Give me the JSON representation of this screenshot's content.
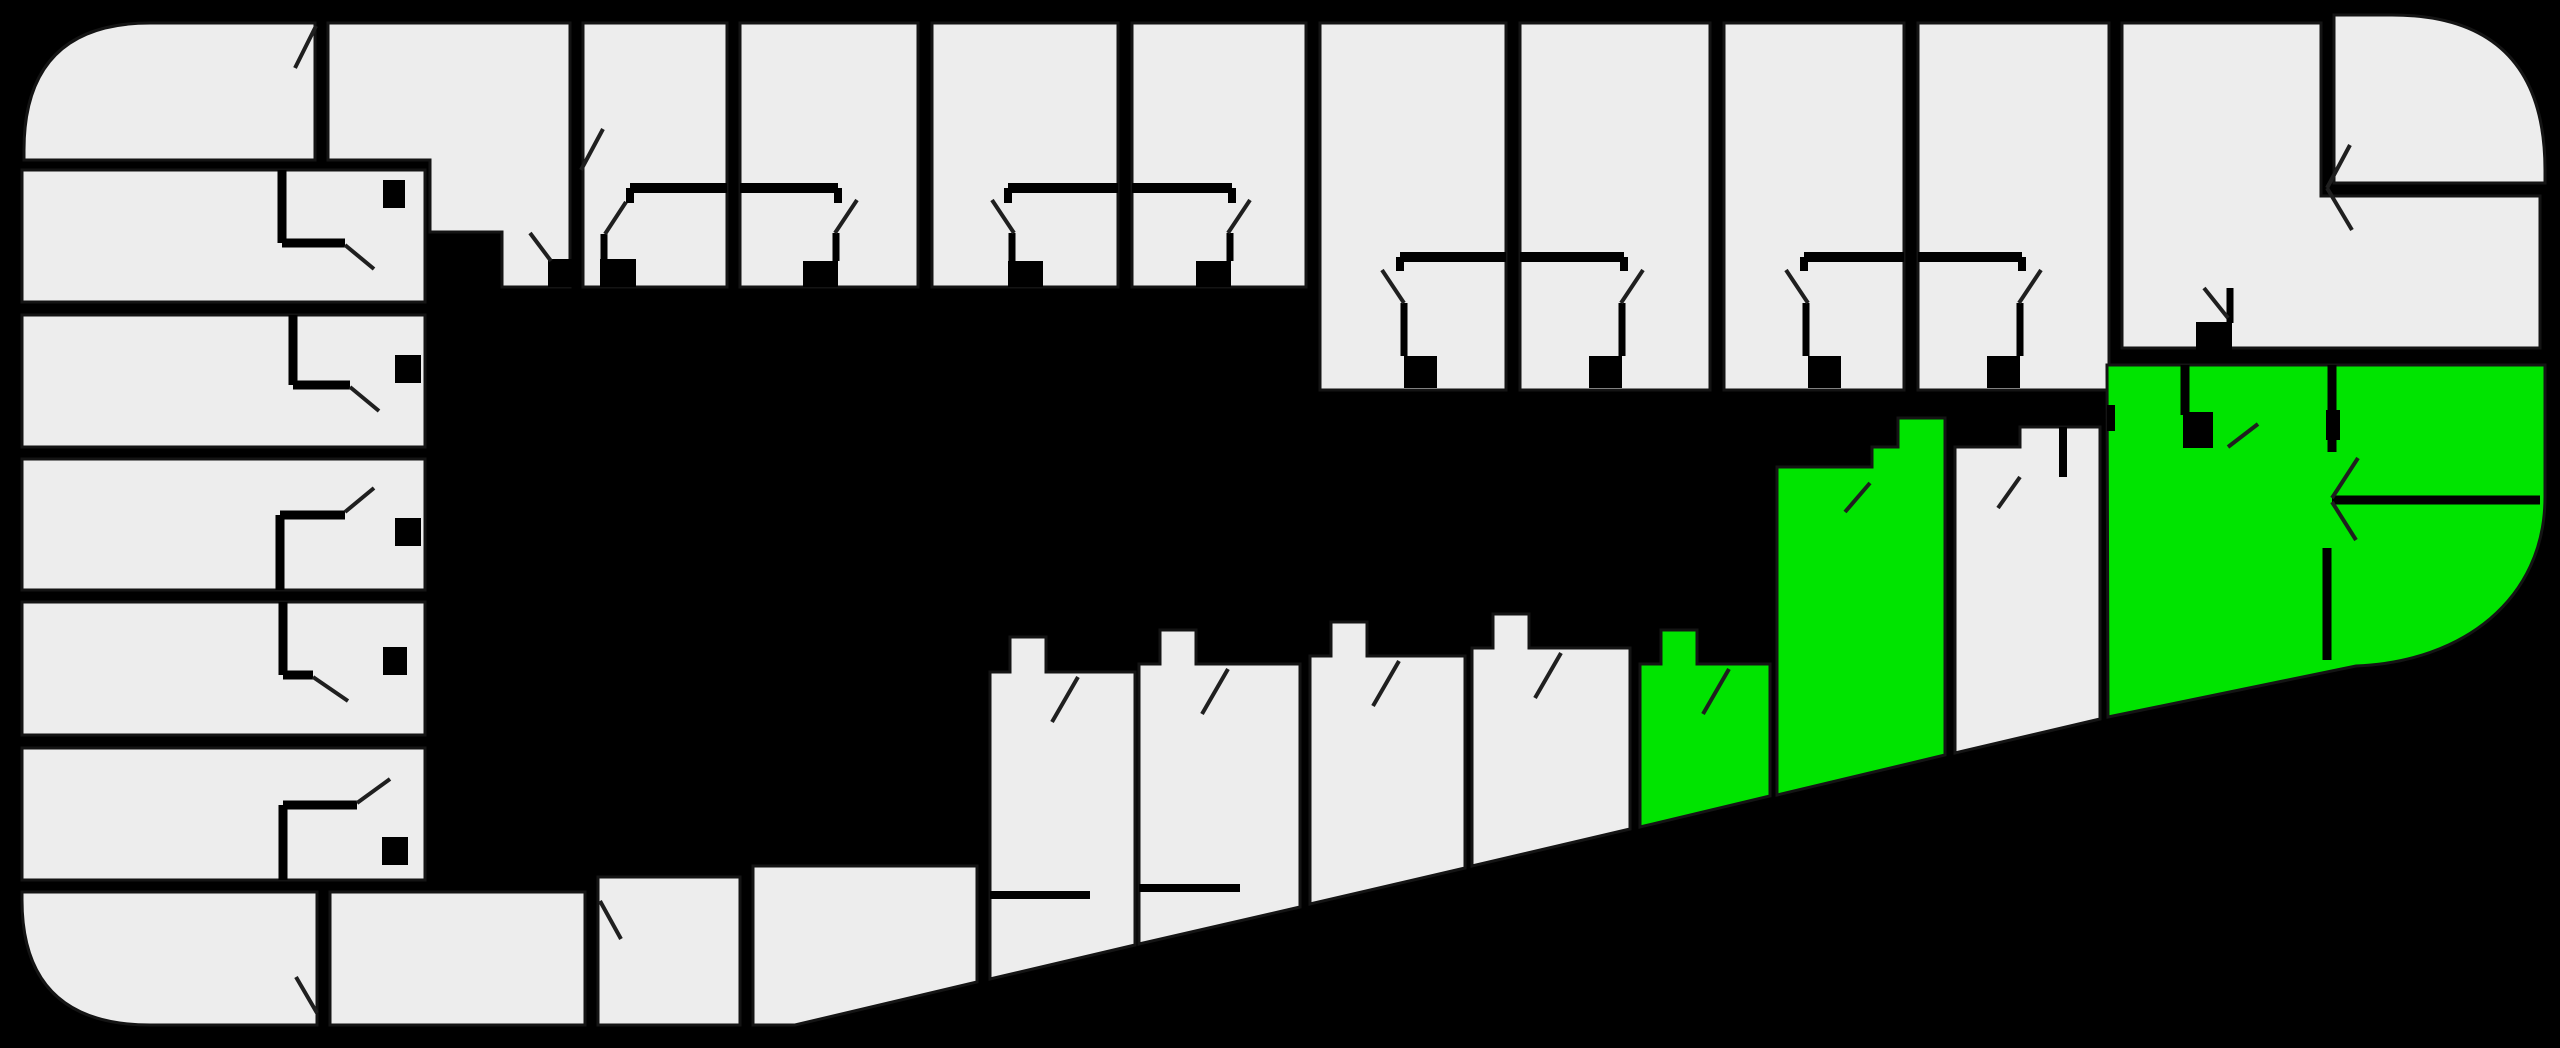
{
  "plan": {
    "title": "building-floor-plan",
    "canvas": {
      "width": 2560,
      "height": 1048,
      "background": "#000000"
    },
    "palette": {
      "unit_fill": "#ededed",
      "available_fill": "#00e400",
      "wall": "#000000",
      "door_line": "#1f1f1f",
      "unit_outline": "#141414"
    },
    "counts": {
      "total_units": 21,
      "available_units": 3
    },
    "units": [
      {
        "id": "L1",
        "status": "occupied",
        "d": "M150,23 H315 V160 H24 V150 Q24,23 150,23 Z"
      },
      {
        "id": "L2",
        "status": "occupied",
        "d": "M22,170 H425 V302 H22 Z"
      },
      {
        "id": "L3",
        "status": "occupied",
        "d": "M22,315 H425 V447 H22 Z"
      },
      {
        "id": "L4",
        "status": "occupied",
        "d": "M22,459 H425 V590 H22 Z"
      },
      {
        "id": "L5",
        "status": "occupied",
        "d": "M22,602 H425 V735 H22 Z"
      },
      {
        "id": "L6",
        "status": "occupied",
        "d": "M22,748 H425 V880 H22 Z"
      },
      {
        "id": "L7",
        "status": "occupied",
        "d": "M22,892 H317 V1025 H150 Q22,1025 22,900 Z"
      },
      {
        "id": "B1",
        "status": "occupied",
        "d": "M330,892 H585 V1025 H330 Z"
      },
      {
        "id": "B2",
        "status": "occupied",
        "d": "M598,877 H740 V1025 H598 Z"
      },
      {
        "id": "B3",
        "status": "occupied",
        "d": "M753,866 H977 V982 L795,1025 H753 Z"
      },
      {
        "id": "T1",
        "status": "occupied",
        "d": "M328,23 H570 V287 H502 V232 H430 V160 H328 Z"
      },
      {
        "id": "T2",
        "status": "occupied",
        "d": "M583,23 H727 V287 H583 Z"
      },
      {
        "id": "T3",
        "status": "occupied",
        "d": "M740,23 H918 V287 H740 Z"
      },
      {
        "id": "T4",
        "status": "occupied",
        "d": "M932,23 H1118 V287 H932 Z"
      },
      {
        "id": "T5",
        "status": "occupied",
        "d": "M1132,23 H1306 V287 H1132 Z"
      },
      {
        "id": "T6",
        "status": "occupied",
        "d": "M1320,23 H1506 V390 H1320 Z"
      },
      {
        "id": "T7",
        "status": "occupied",
        "d": "M1520,23 H1710 V390 H1520 Z"
      },
      {
        "id": "T8",
        "status": "occupied",
        "d": "M1724,23 H1904 V390 H1724 Z"
      },
      {
        "id": "T9",
        "status": "occupied",
        "d": "M1918,23 H2109 V390 H1918 Z"
      },
      {
        "id": "T10",
        "status": "occupied",
        "d": "M2122,23 H2321 V196 H2540 V348 H2122 Z"
      },
      {
        "id": "T11",
        "status": "occupied",
        "d": "M2334,15 H2392 Q2545,15 2545,170 V183 H2334 Z"
      },
      {
        "id": "C1",
        "status": "occupied",
        "d": "M990,672 H1010 V637 H1046 V672 H1135 V945 L990,979 Z"
      },
      {
        "id": "C2",
        "status": "occupied",
        "d": "M1139,664 H1160 V630 H1196 V664 H1300 V907 L1139,944 Z"
      },
      {
        "id": "C3",
        "status": "occupied",
        "d": "M1310,656 H1331 V622 H1367 V656 H1465 V868 L1310,904 Z"
      },
      {
        "id": "C4",
        "status": "occupied",
        "d": "M1472,648 H1493 V614 H1529 V648 H1630 V829 L1472,866 Z"
      },
      {
        "id": "M1",
        "status": "available",
        "d": "M1640,664 H1661 V630 H1697 V664 H1770 V796 L1640,827 Z"
      },
      {
        "id": "M2",
        "status": "available",
        "d": "M1777,467 H1872 V447 H1898 V418 H1945 V755 L1777,795 Z"
      },
      {
        "id": "D1",
        "status": "occupied",
        "d": "M1955,447 H2020 V427 H2100 V719 L1955,753 Z"
      },
      {
        "id": "G1",
        "status": "available",
        "d": "M2107,365 H2545 V497 C2545,600 2462,662 2356,666 L2108,717 Z"
      }
    ],
    "interior_walls": [
      {
        "x1": 282,
        "y1": 170,
        "x2": 282,
        "y2": 243,
        "w": 9
      },
      {
        "x1": 282,
        "y1": 243,
        "x2": 345,
        "y2": 243,
        "w": 9
      },
      {
        "x1": 293,
        "y1": 315,
        "x2": 293,
        "y2": 385,
        "w": 9
      },
      {
        "x1": 293,
        "y1": 385,
        "x2": 350,
        "y2": 385,
        "w": 9
      },
      {
        "x1": 280,
        "y1": 515,
        "x2": 345,
        "y2": 515,
        "w": 9
      },
      {
        "x1": 280,
        "y1": 515,
        "x2": 280,
        "y2": 590,
        "w": 9
      },
      {
        "x1": 283,
        "y1": 602,
        "x2": 283,
        "y2": 675,
        "w": 9
      },
      {
        "x1": 283,
        "y1": 675,
        "x2": 313,
        "y2": 675,
        "w": 9
      },
      {
        "x1": 283,
        "y1": 805,
        "x2": 357,
        "y2": 805,
        "w": 9
      },
      {
        "x1": 283,
        "y1": 805,
        "x2": 283,
        "y2": 880,
        "w": 9
      },
      {
        "x1": 630,
        "y1": 188,
        "x2": 727,
        "y2": 188,
        "w": 10
      },
      {
        "x1": 630,
        "y1": 188,
        "x2": 630,
        "y2": 203,
        "w": 8
      },
      {
        "x1": 740,
        "y1": 188,
        "x2": 838,
        "y2": 188,
        "w": 10
      },
      {
        "x1": 838,
        "y1": 188,
        "x2": 838,
        "y2": 203,
        "w": 8
      },
      {
        "x1": 1008,
        "y1": 188,
        "x2": 1118,
        "y2": 188,
        "w": 10
      },
      {
        "x1": 1008,
        "y1": 188,
        "x2": 1008,
        "y2": 203,
        "w": 8
      },
      {
        "x1": 1132,
        "y1": 188,
        "x2": 1232,
        "y2": 188,
        "w": 10
      },
      {
        "x1": 1232,
        "y1": 188,
        "x2": 1232,
        "y2": 203,
        "w": 8
      },
      {
        "x1": 1400,
        "y1": 257,
        "x2": 1506,
        "y2": 257,
        "w": 10
      },
      {
        "x1": 1400,
        "y1": 257,
        "x2": 1400,
        "y2": 271,
        "w": 8
      },
      {
        "x1": 1520,
        "y1": 257,
        "x2": 1624,
        "y2": 257,
        "w": 10
      },
      {
        "x1": 1624,
        "y1": 257,
        "x2": 1624,
        "y2": 271,
        "w": 8
      },
      {
        "x1": 1804,
        "y1": 257,
        "x2": 1904,
        "y2": 257,
        "w": 10
      },
      {
        "x1": 1804,
        "y1": 257,
        "x2": 1804,
        "y2": 271,
        "w": 8
      },
      {
        "x1": 1918,
        "y1": 257,
        "x2": 2022,
        "y2": 257,
        "w": 10
      },
      {
        "x1": 2022,
        "y1": 257,
        "x2": 2022,
        "y2": 271,
        "w": 8
      },
      {
        "x1": 604,
        "y1": 234,
        "x2": 604,
        "y2": 261,
        "w": 7
      },
      {
        "x1": 836,
        "y1": 233,
        "x2": 836,
        "y2": 261,
        "w": 7
      },
      {
        "x1": 1012,
        "y1": 233,
        "x2": 1012,
        "y2": 261,
        "w": 7
      },
      {
        "x1": 1230,
        "y1": 233,
        "x2": 1230,
        "y2": 261,
        "w": 7
      },
      {
        "x1": 1404,
        "y1": 303,
        "x2": 1404,
        "y2": 356,
        "w": 7
      },
      {
        "x1": 1622,
        "y1": 303,
        "x2": 1622,
        "y2": 356,
        "w": 7
      },
      {
        "x1": 1806,
        "y1": 303,
        "x2": 1806,
        "y2": 356,
        "w": 7
      },
      {
        "x1": 2020,
        "y1": 303,
        "x2": 2020,
        "y2": 356,
        "w": 7
      },
      {
        "x1": 2230,
        "y1": 288,
        "x2": 2230,
        "y2": 323,
        "w": 7
      },
      {
        "x1": 990,
        "y1": 895,
        "x2": 1090,
        "y2": 895,
        "w": 8
      },
      {
        "x1": 1139,
        "y1": 888,
        "x2": 1240,
        "y2": 888,
        "w": 8
      },
      {
        "x1": 2063,
        "y1": 427,
        "x2": 2063,
        "y2": 477,
        "w": 8
      },
      {
        "x1": 2332,
        "y1": 365,
        "x2": 2332,
        "y2": 452,
        "w": 9
      },
      {
        "x1": 2332,
        "y1": 500,
        "x2": 2540,
        "y2": 500,
        "w": 9
      },
      {
        "x1": 2327,
        "y1": 548,
        "x2": 2327,
        "y2": 660,
        "w": 9
      },
      {
        "x1": 2185,
        "y1": 365,
        "x2": 2185,
        "y2": 415,
        "w": 9
      }
    ],
    "door_swings": [
      {
        "x1": 295,
        "y1": 68,
        "x2": 316,
        "y2": 26
      },
      {
        "x1": 345,
        "y1": 245,
        "x2": 374,
        "y2": 269
      },
      {
        "x1": 350,
        "y1": 387,
        "x2": 379,
        "y2": 411
      },
      {
        "x1": 345,
        "y1": 512,
        "x2": 374,
        "y2": 488
      },
      {
        "x1": 313,
        "y1": 677,
        "x2": 348,
        "y2": 701
      },
      {
        "x1": 357,
        "y1": 803,
        "x2": 390,
        "y2": 779
      },
      {
        "x1": 296,
        "y1": 977,
        "x2": 317,
        "y2": 1013
      },
      {
        "x1": 600,
        "y1": 901,
        "x2": 621,
        "y2": 939
      },
      {
        "x1": 530,
        "y1": 233,
        "x2": 551,
        "y2": 261
      },
      {
        "x1": 581,
        "y1": 170,
        "x2": 603,
        "y2": 129
      },
      {
        "x1": 626,
        "y1": 202,
        "x2": 605,
        "y2": 234
      },
      {
        "x1": 857,
        "y1": 200,
        "x2": 835,
        "y2": 233
      },
      {
        "x1": 992,
        "y1": 200,
        "x2": 1014,
        "y2": 233
      },
      {
        "x1": 1250,
        "y1": 200,
        "x2": 1228,
        "y2": 233
      },
      {
        "x1": 1382,
        "y1": 270,
        "x2": 1404,
        "y2": 303
      },
      {
        "x1": 1643,
        "y1": 270,
        "x2": 1621,
        "y2": 303
      },
      {
        "x1": 1786,
        "y1": 270,
        "x2": 1808,
        "y2": 303
      },
      {
        "x1": 2041,
        "y1": 270,
        "x2": 2019,
        "y2": 303
      },
      {
        "x1": 2204,
        "y1": 288,
        "x2": 2228,
        "y2": 318
      },
      {
        "x1": 2327,
        "y1": 188,
        "x2": 2350,
        "y2": 145
      },
      {
        "x1": 2327,
        "y1": 188,
        "x2": 2352,
        "y2": 230
      },
      {
        "x1": 1078,
        "y1": 677,
        "x2": 1052,
        "y2": 722
      },
      {
        "x1": 1228,
        "y1": 669,
        "x2": 1202,
        "y2": 714
      },
      {
        "x1": 1399,
        "y1": 661,
        "x2": 1373,
        "y2": 706
      },
      {
        "x1": 1561,
        "y1": 653,
        "x2": 1535,
        "y2": 698
      },
      {
        "x1": 1729,
        "y1": 669,
        "x2": 1703,
        "y2": 714
      },
      {
        "x1": 1870,
        "y1": 483,
        "x2": 1845,
        "y2": 512
      },
      {
        "x1": 2020,
        "y1": 477,
        "x2": 1998,
        "y2": 508
      },
      {
        "x1": 2228,
        "y1": 447,
        "x2": 2258,
        "y2": 424
      },
      {
        "x1": 2332,
        "y1": 498,
        "x2": 2358,
        "y2": 458
      },
      {
        "x1": 2332,
        "y1": 502,
        "x2": 2356,
        "y2": 540
      }
    ],
    "entry_notches": [
      {
        "x": 383,
        "y": 180,
        "w": 22,
        "h": 28
      },
      {
        "x": 395,
        "y": 355,
        "w": 26,
        "h": 28
      },
      {
        "x": 395,
        "y": 518,
        "w": 26,
        "h": 28
      },
      {
        "x": 383,
        "y": 647,
        "w": 24,
        "h": 28
      },
      {
        "x": 382,
        "y": 837,
        "w": 26,
        "h": 28
      },
      {
        "x": 548,
        "y": 259,
        "w": 26,
        "h": 28
      },
      {
        "x": 600,
        "y": 259,
        "w": 36,
        "h": 28
      },
      {
        "x": 803,
        "y": 261,
        "w": 35,
        "h": 26
      },
      {
        "x": 1008,
        "y": 261,
        "w": 35,
        "h": 26
      },
      {
        "x": 1196,
        "y": 261,
        "w": 35,
        "h": 26
      },
      {
        "x": 1404,
        "y": 356,
        "w": 33,
        "h": 32
      },
      {
        "x": 1589,
        "y": 356,
        "w": 33,
        "h": 32
      },
      {
        "x": 1808,
        "y": 356,
        "w": 33,
        "h": 32
      },
      {
        "x": 1987,
        "y": 356,
        "w": 33,
        "h": 32
      },
      {
        "x": 2196,
        "y": 322,
        "w": 36,
        "h": 28
      },
      {
        "x": 2183,
        "y": 412,
        "w": 30,
        "h": 36
      },
      {
        "x": 2107,
        "y": 405,
        "w": 8,
        "h": 26
      },
      {
        "x": 2326,
        "y": 410,
        "w": 14,
        "h": 30
      }
    ]
  }
}
